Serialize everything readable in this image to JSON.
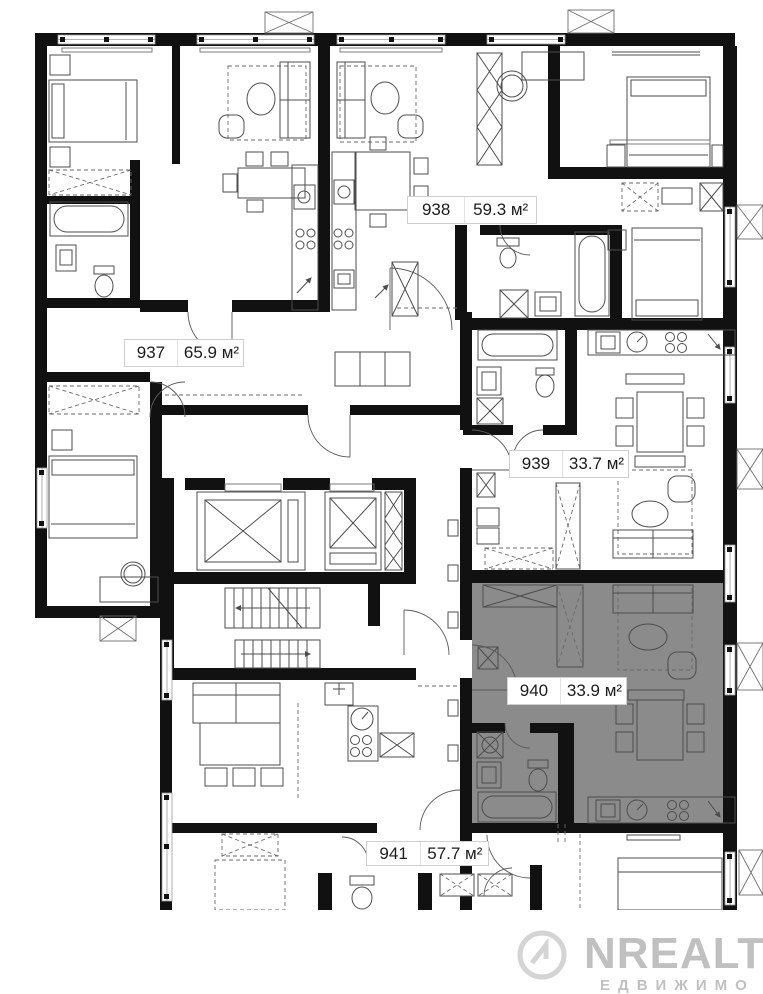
{
  "units": [
    {
      "number": "937",
      "area": "65.9 м²",
      "highlighted": false
    },
    {
      "number": "938",
      "area": "59.3 м²",
      "highlighted": false
    },
    {
      "number": "939",
      "area": "33.7 м²",
      "highlighted": false
    },
    {
      "number": "940",
      "area": "33.9 м²",
      "highlighted": true
    },
    {
      "number": "941",
      "area": "57.7 м²",
      "highlighted": false
    }
  ],
  "watermark": {
    "brand": "NREALT",
    "subtitle": "ЕДВИЖИМО"
  },
  "colors": {
    "highlight": "#8b8b8b",
    "wall": "#111111",
    "furniture": "#4d4d4d"
  }
}
